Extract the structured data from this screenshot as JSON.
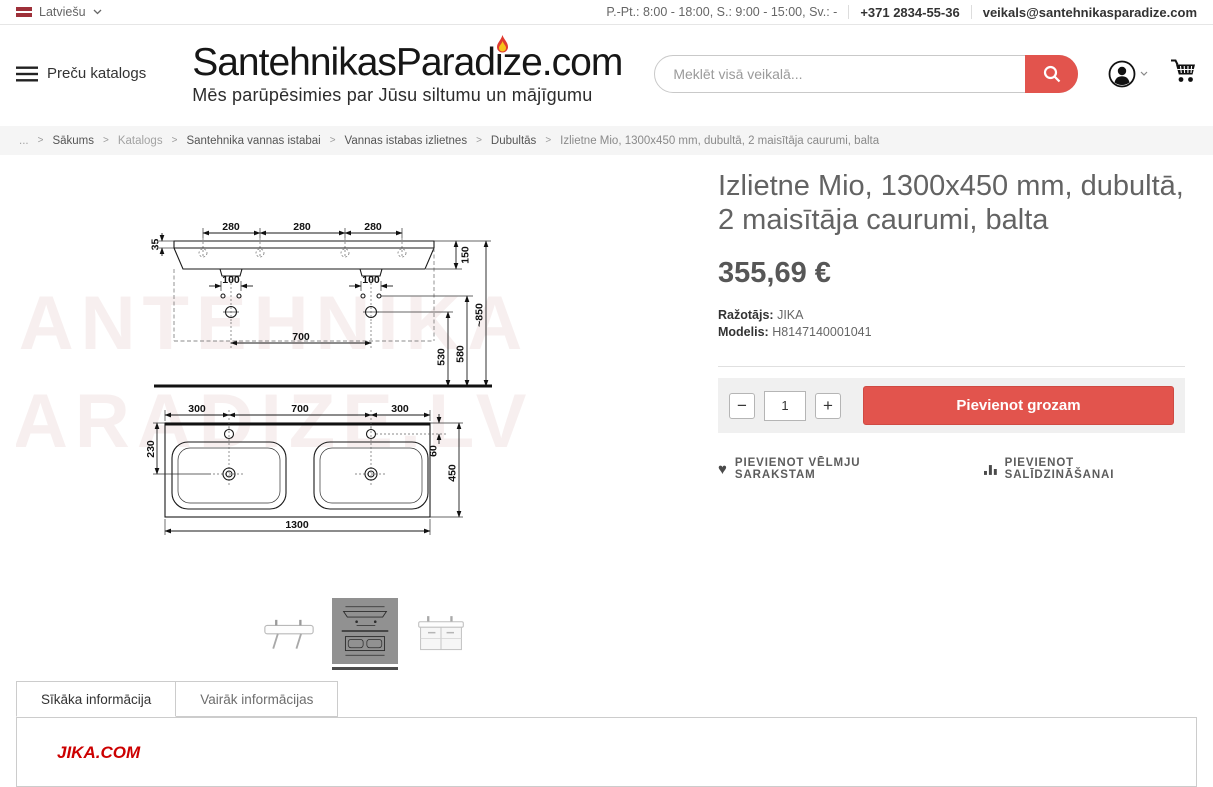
{
  "topbar": {
    "language": "Latviešu",
    "hours": "P.-Pt.: 8:00 - 18:00, S.: 9:00 - 15:00, Sv.: -",
    "phone": "+371 2834-55-36",
    "email": "veikals@santehnikasparadize.com"
  },
  "header": {
    "catalog_button": "Preču katalogs",
    "logo_text": "SantehnikasParadize.com",
    "tagline": "Mēs parūpēsimies par Jūsu siltumu un mājīgumu",
    "search_placeholder": "Meklēt visā veikalā..."
  },
  "breadcrumb": {
    "separator": ">",
    "items": [
      "...",
      "Sākums",
      "Katalogs",
      "Santehnika vannas istabai",
      "Vannas istabas izlietnes",
      "Dubultās",
      "Izlietne Mio, 1300x450 mm, dubultā, 2 maisītāja caurumi, balta"
    ]
  },
  "product": {
    "title": "Izlietne Mio, 1300x450 mm, dubultā, 2 maisītāja caurumi, balta",
    "price": "355,69 €",
    "manufacturer_label": "Ražotājs:",
    "manufacturer": "JIKA",
    "model_label": "Modelis:",
    "model": "H8147140001041",
    "qty": "1",
    "qty_minus": "−",
    "qty_plus": "+",
    "add_to_cart": "Pievienot grozam",
    "wishlist": "PIEVIENOT VĒLMJU SARAKSTAM",
    "compare": "PIEVIENOT SALĪDZINĀŠANAI",
    "wishlist_icon": "♥"
  },
  "drawing": {
    "watermark_line1": "SANTEHNIKA",
    "watermark_line2": "PARADIZE.LV",
    "dims": {
      "h35": "35",
      "w280": "280",
      "w100": "100",
      "w700": "700",
      "h150": "150",
      "h850": "~850",
      "h580": "580",
      "h530": "530",
      "w300": "300",
      "h230": "230",
      "h60": "60",
      "h450": "450",
      "w1300": "1300"
    }
  },
  "tabs": {
    "tab1": "Sīkāka informācija",
    "tab2": "Vairāk informācijas",
    "content_brand": "JIKA.COM"
  },
  "colors": {
    "accent_red": "#e2544d",
    "brand_red": "#cc0000",
    "flag_red": "#9e3039",
    "breadcrumb_bg": "#f5f5f5",
    "buybox_bg": "#f0f0f0"
  }
}
